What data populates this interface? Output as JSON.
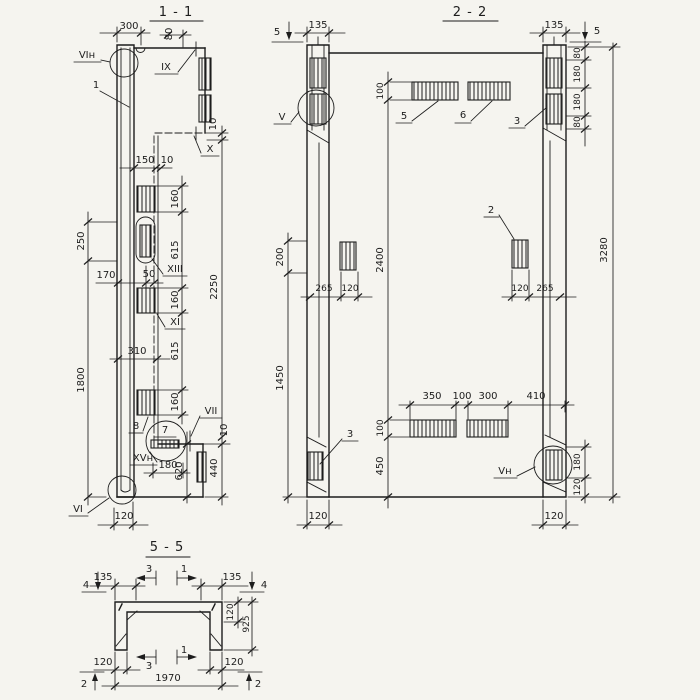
{
  "colors": {
    "paper": "#f5f4ef",
    "ink": "#1d1d1d"
  },
  "sections": {
    "s11": {
      "title": "1 - 1",
      "labels": {
        "vi_top": "VIн",
        "item1": "1",
        "ix": "IX",
        "x": "X",
        "xiii": "XIII",
        "xi": "XI",
        "item8": "8",
        "item7": "7",
        "vii": "VII",
        "xv": "XVн",
        "vi_bottom": "VI"
      },
      "dims": {
        "d300": "300",
        "d80": "80",
        "d150": "150",
        "d10web": "10",
        "d10step": "10",
        "d250": "250",
        "d1800": "1800",
        "d160a": "160",
        "d615a": "615",
        "d160b": "160",
        "d615b": "615",
        "d160c": "160",
        "d170": "170",
        "d50": "50",
        "d310": "310",
        "d2250": "2250",
        "d10plate": "10",
        "d180": "180",
        "d620": "620",
        "d440": "440",
        "d120": "120"
      }
    },
    "s22": {
      "title": "2 - 2",
      "cut_marks": {
        "left": "5",
        "right": "5"
      },
      "labels": {
        "v": "V",
        "vn": "Vн",
        "item2": "2",
        "item3top": "3",
        "item3bot": "3",
        "item5": "5",
        "item6": "6"
      },
      "dims": {
        "d135l": "135",
        "d135r": "135",
        "d80a": "80",
        "d180a": "180",
        "d180b": "180",
        "d80b": "80",
        "d3280": "3280",
        "d100top": "100",
        "d2400": "2400",
        "d100mid": "100",
        "d450": "450",
        "d200": "200",
        "d1450": "1450",
        "d265l": "265",
        "d120lsq": "120",
        "d120rsq": "120",
        "d265r": "265",
        "d350": "350",
        "d100bot": "100",
        "d300": "300",
        "d410": "410",
        "d120lcol": "120",
        "d120rcol": "120",
        "d180br": "180",
        "d120br": "120"
      }
    },
    "s55": {
      "title": "5 - 5",
      "cut_marks": {
        "c4l": "4",
        "c4r": "4",
        "c3top": "3",
        "c1top": "1",
        "c3bot": "3",
        "c1bot": "1",
        "c2l": "2",
        "c2r": "2"
      },
      "dims": {
        "d135l": "135",
        "d135r": "135",
        "d120side": "120",
        "d925": "925",
        "d120bl": "120",
        "d120br": "120",
        "d1970": "1970"
      }
    }
  }
}
